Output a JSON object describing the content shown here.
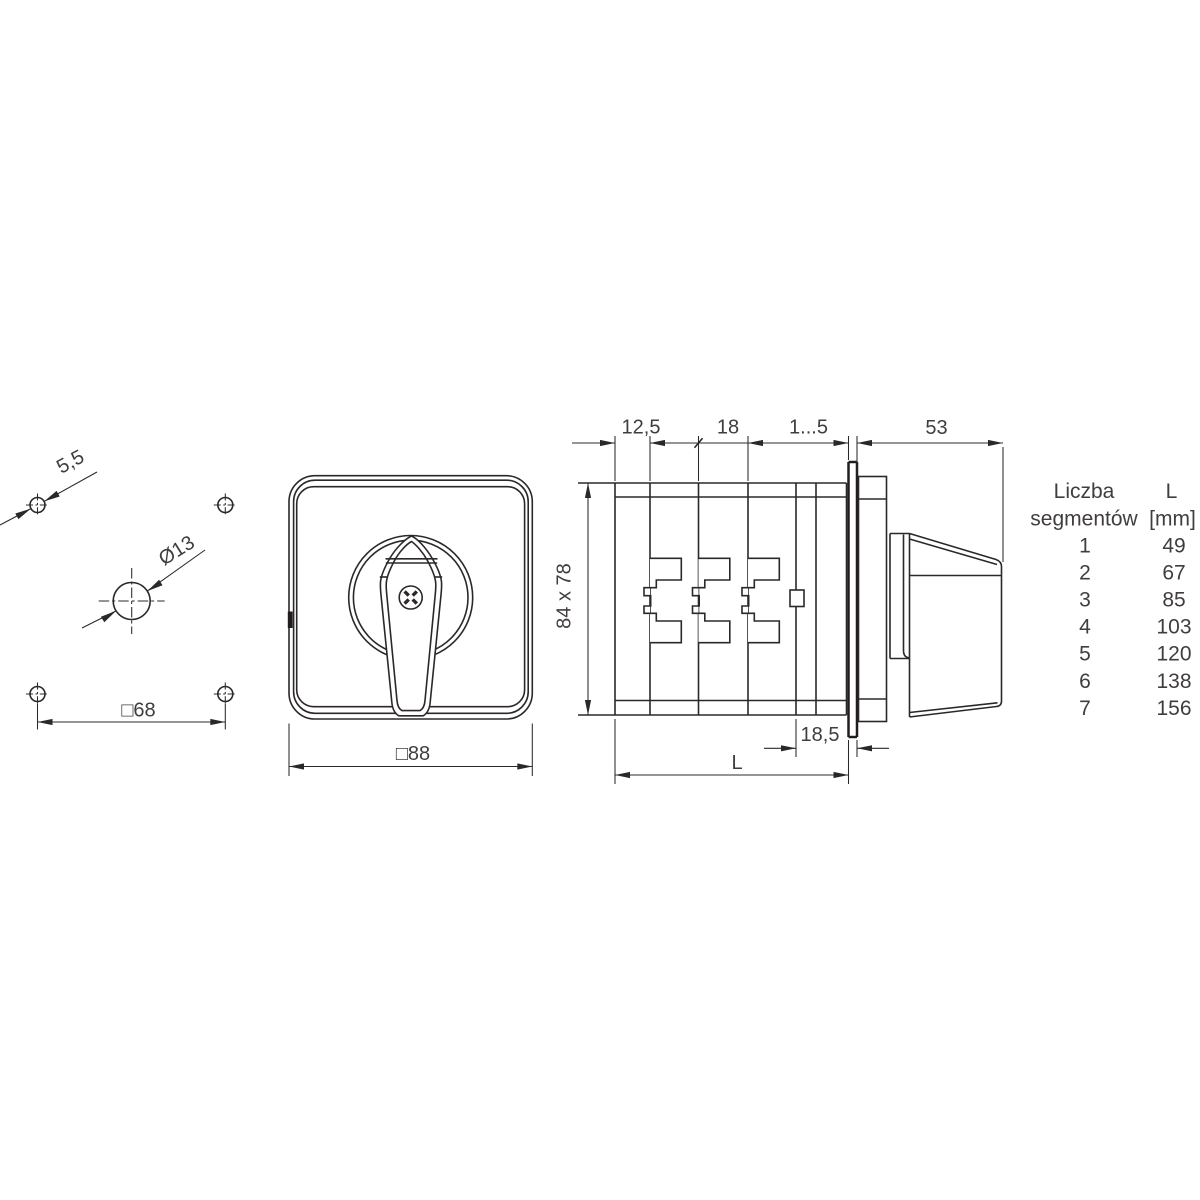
{
  "colors": {
    "line": "#2c2829",
    "text": "#413d3e",
    "background": "#ffffff"
  },
  "drill_view": {
    "dim_corner_hole": "5,5",
    "dim_center_hole": "Ø13",
    "dim_hole_spacing": "□68"
  },
  "front_view": {
    "dim_face_size": "□88"
  },
  "side_view": {
    "dim_rear_section": "12,5",
    "dim_segment_width": "18",
    "dim_panel_thickness": "1...5",
    "dim_handle_depth": "53",
    "dim_body_height": "84 x 78",
    "dim_front_depth": "18,5",
    "dim_total_length": "L"
  },
  "segments_table": {
    "header_col1": [
      "Liczba",
      "segmentów"
    ],
    "header_col2": [
      "L",
      "[mm]"
    ],
    "rows": [
      {
        "segments": "1",
        "length_mm": "49"
      },
      {
        "segments": "2",
        "length_mm": "67"
      },
      {
        "segments": "3",
        "length_mm": "85"
      },
      {
        "segments": "4",
        "length_mm": "103"
      },
      {
        "segments": "5",
        "length_mm": "120"
      },
      {
        "segments": "6",
        "length_mm": "138"
      },
      {
        "segments": "7",
        "length_mm": "156"
      }
    ]
  }
}
